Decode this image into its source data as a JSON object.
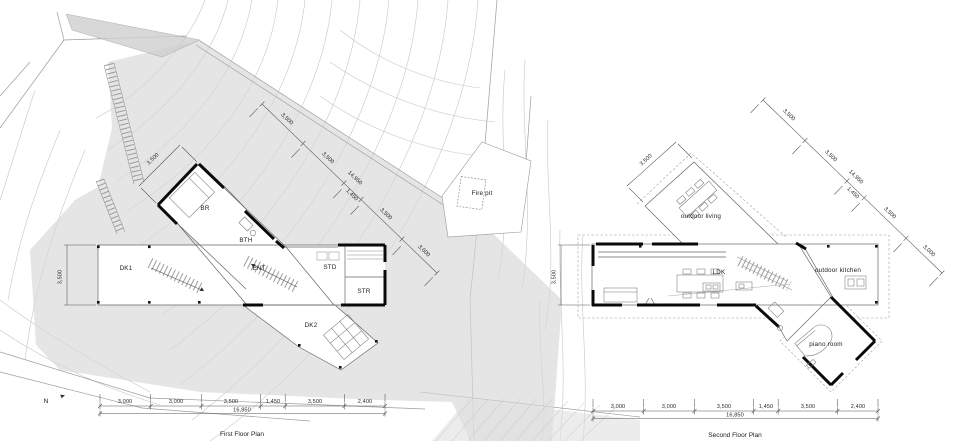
{
  "first_floor": {
    "caption": "First Floor Plan",
    "north_label": "N",
    "rooms": {
      "br": "BR",
      "bth": "BTH",
      "dk1": "DK1",
      "ent": "ENT",
      "std": "STD",
      "str": "STR",
      "dk2": "DK2",
      "fire_pit": "Fire pit"
    },
    "dims": {
      "depth": "3,500",
      "wing_width": "3,500",
      "diagonal_segments": [
        "3,500",
        "3,500",
        "1,450",
        "3,500",
        "3,000"
      ],
      "diagonal_total": "14,950",
      "bottom_segments": [
        "3,000",
        "3,000",
        "3,500",
        "1,450",
        "3,500",
        "2,400"
      ],
      "bottom_total": "16,850"
    }
  },
  "second_floor": {
    "caption": "Second Floor Plan",
    "rooms": {
      "outdoor_living": "outdoor living",
      "ldk": "LDK",
      "outdoor_kitchen": "outdoor kitchen",
      "piano_room": "piano room"
    },
    "dims": {
      "depth": "3,500",
      "wing_width": "3,500",
      "diagonal_segments": [
        "3,500",
        "3,500",
        "1,450",
        "3,500",
        "3,000"
      ],
      "diagonal_total": "14,950",
      "bottom_segments": [
        "3,000",
        "3,000",
        "3,500",
        "1,450",
        "3,500",
        "2,400"
      ],
      "bottom_total": "16,850"
    }
  },
  "colors": {
    "wall": "#0a0a0a",
    "site_gray": "#e3e3e3",
    "contour": "#c6c6c6"
  }
}
